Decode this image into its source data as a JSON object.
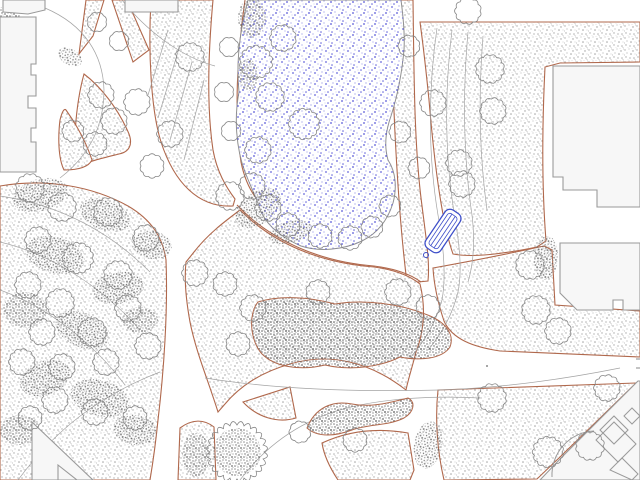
{
  "map": {
    "kind": "landscape-site-plan",
    "canvas": {
      "width": 640,
      "height": 480
    },
    "colors": {
      "background": "#ffffff",
      "ground_dot": "#a9a9a9",
      "canopy_dot": "#6b6b6b",
      "path_edge": "#b0684c",
      "contour": "#a3a3a3",
      "tree_outline": "#878787",
      "building_fill": "#f7f7f7",
      "building_outline": "#9a9a9a",
      "pond_fill": "#ffffff",
      "pond_outline": "#909090",
      "pond_dot": "#3b3bd0",
      "bench_blue": "#3d4ec9"
    },
    "features": {
      "pond": {
        "kind": "water-body",
        "texture": "blue-stipple"
      },
      "bench": {
        "kind": "park-bench",
        "x": 443,
        "y": 231,
        "angle": -56,
        "length": 46,
        "width": 18
      },
      "buildings_count": 10,
      "contour_lines_count": 18,
      "trees": [
        [
          190,
          57,
          13
        ],
        [
          256,
          62,
          15
        ],
        [
          283,
          38,
          12
        ],
        [
          270,
          97,
          13
        ],
        [
          304,
          124,
          14
        ],
        [
          258,
          150,
          12
        ],
        [
          230,
          196,
          13
        ],
        [
          252,
          186,
          12
        ],
        [
          268,
          208,
          12
        ],
        [
          288,
          225,
          11
        ],
        [
          320,
          236,
          11
        ],
        [
          350,
          238,
          11
        ],
        [
          372,
          227,
          10
        ],
        [
          390,
          206,
          10
        ],
        [
          229,
          47,
          9
        ],
        [
          224,
          92,
          9
        ],
        [
          231,
          131,
          9
        ],
        [
          97,
          22,
          9
        ],
        [
          119,
          41,
          9
        ],
        [
          101,
          95,
          12
        ],
        [
          114,
          121,
          12
        ],
        [
          95,
          144,
          11
        ],
        [
          73,
          131,
          10
        ],
        [
          137,
          102,
          12
        ],
        [
          170,
          134,
          12
        ],
        [
          152,
          166,
          11
        ],
        [
          30,
          188,
          13
        ],
        [
          62,
          207,
          13
        ],
        [
          108,
          212,
          13
        ],
        [
          146,
          238,
          12
        ],
        [
          38,
          240,
          12
        ],
        [
          78,
          258,
          14
        ],
        [
          118,
          275,
          13
        ],
        [
          28,
          285,
          12
        ],
        [
          60,
          303,
          13
        ],
        [
          128,
          308,
          12
        ],
        [
          92,
          332,
          13
        ],
        [
          42,
          332,
          12
        ],
        [
          22,
          362,
          12
        ],
        [
          62,
          367,
          12
        ],
        [
          106,
          362,
          12
        ],
        [
          148,
          346,
          12
        ],
        [
          55,
          400,
          12
        ],
        [
          95,
          412,
          12
        ],
        [
          30,
          418,
          11
        ],
        [
          135,
          418,
          11
        ],
        [
          409,
          46,
          10
        ],
        [
          400,
          132,
          10
        ],
        [
          419,
          168,
          10
        ],
        [
          468,
          11,
          12
        ],
        [
          490,
          69,
          13
        ],
        [
          433,
          103,
          12
        ],
        [
          493,
          111,
          12
        ],
        [
          459,
          163,
          12
        ],
        [
          462,
          184,
          12
        ],
        [
          530,
          265,
          13
        ],
        [
          536,
          310,
          13
        ],
        [
          558,
          331,
          12
        ],
        [
          492,
          398,
          13
        ],
        [
          548,
          452,
          14
        ],
        [
          590,
          446,
          13
        ],
        [
          607,
          388,
          12
        ],
        [
          253,
          308,
          12
        ],
        [
          318,
          292,
          11
        ],
        [
          398,
          292,
          12
        ],
        [
          428,
          307,
          11
        ],
        [
          238,
          344,
          11
        ],
        [
          195,
          273,
          12
        ],
        [
          225,
          284,
          11
        ],
        [
          355,
          440,
          11
        ],
        [
          300,
          432,
          10
        ],
        [
          237,
          452,
          27
        ]
      ],
      "canopies": [
        [
          40,
          195,
          28,
          16,
          -15
        ],
        [
          105,
          215,
          26,
          15,
          20
        ],
        [
          152,
          245,
          20,
          14,
          10
        ],
        [
          55,
          255,
          30,
          18,
          15
        ],
        [
          118,
          288,
          26,
          16,
          -10
        ],
        [
          25,
          310,
          22,
          18,
          0
        ],
        [
          82,
          330,
          28,
          17,
          25
        ],
        [
          140,
          320,
          18,
          13,
          0
        ],
        [
          45,
          378,
          26,
          17,
          -20
        ],
        [
          100,
          398,
          30,
          18,
          15
        ],
        [
          20,
          430,
          20,
          15,
          0
        ],
        [
          135,
          430,
          22,
          15,
          10
        ],
        [
          8,
          14,
          12,
          8,
          0
        ],
        [
          70,
          57,
          13,
          8,
          30
        ],
        [
          258,
          208,
          26,
          16,
          -35
        ],
        [
          290,
          232,
          22,
          11,
          -15
        ],
        [
          252,
          18,
          14,
          20,
          0
        ],
        [
          248,
          75,
          10,
          16,
          0
        ],
        [
          546,
          258,
          12,
          22,
          5
        ],
        [
          428,
          445,
          14,
          24,
          10
        ],
        [
          196,
          455,
          14,
          22,
          0
        ],
        [
          237,
          452,
          24,
          24,
          0
        ]
      ]
    }
  }
}
